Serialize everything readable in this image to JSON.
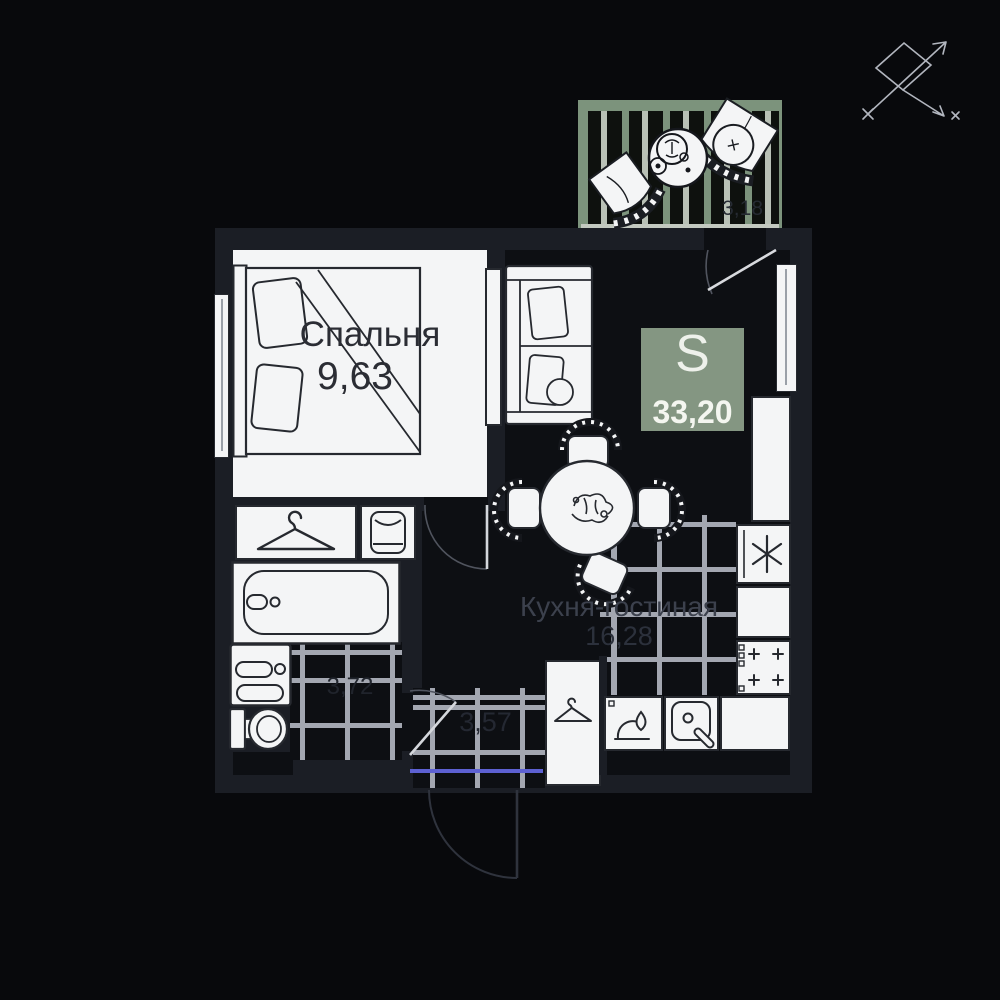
{
  "plan_title": "apartment-floor-plan",
  "badge": {
    "label": "S",
    "area": "33,20"
  },
  "rooms": {
    "bedroom": {
      "label": "Спальня",
      "area": "9,63"
    },
    "kitchen_living": {
      "label": "Кухня-гостиная",
      "area": "16,28"
    },
    "bathroom": {
      "area": "3,72"
    },
    "hallway": {
      "area": "3,57"
    },
    "balcony": {
      "area": "3,18"
    }
  },
  "colors": {
    "background": "#08090c",
    "wall": "#1b1e25",
    "floor_dark": "#0d0f13",
    "room_white": "#f4f5f6",
    "furniture_line": "#26292f",
    "tile_grout": "#a3a7b1",
    "badge_green": "#849682",
    "balcony_green": "#7c937c",
    "balcony_light_band": "#c3c9c0",
    "entry_line_blue": "#5d61d2",
    "compass_gray": "#b2b6bf"
  },
  "icons": {
    "compass": "compass-icon",
    "closet": "hanger-icon",
    "hall_closet": "hanger-icon",
    "dresser": "shirt-icon",
    "fridge": "asterisk-icon",
    "hob": "burners-plus-icon",
    "kitchen_sink": "sink-icon",
    "gas_burner": "flame-icon"
  }
}
